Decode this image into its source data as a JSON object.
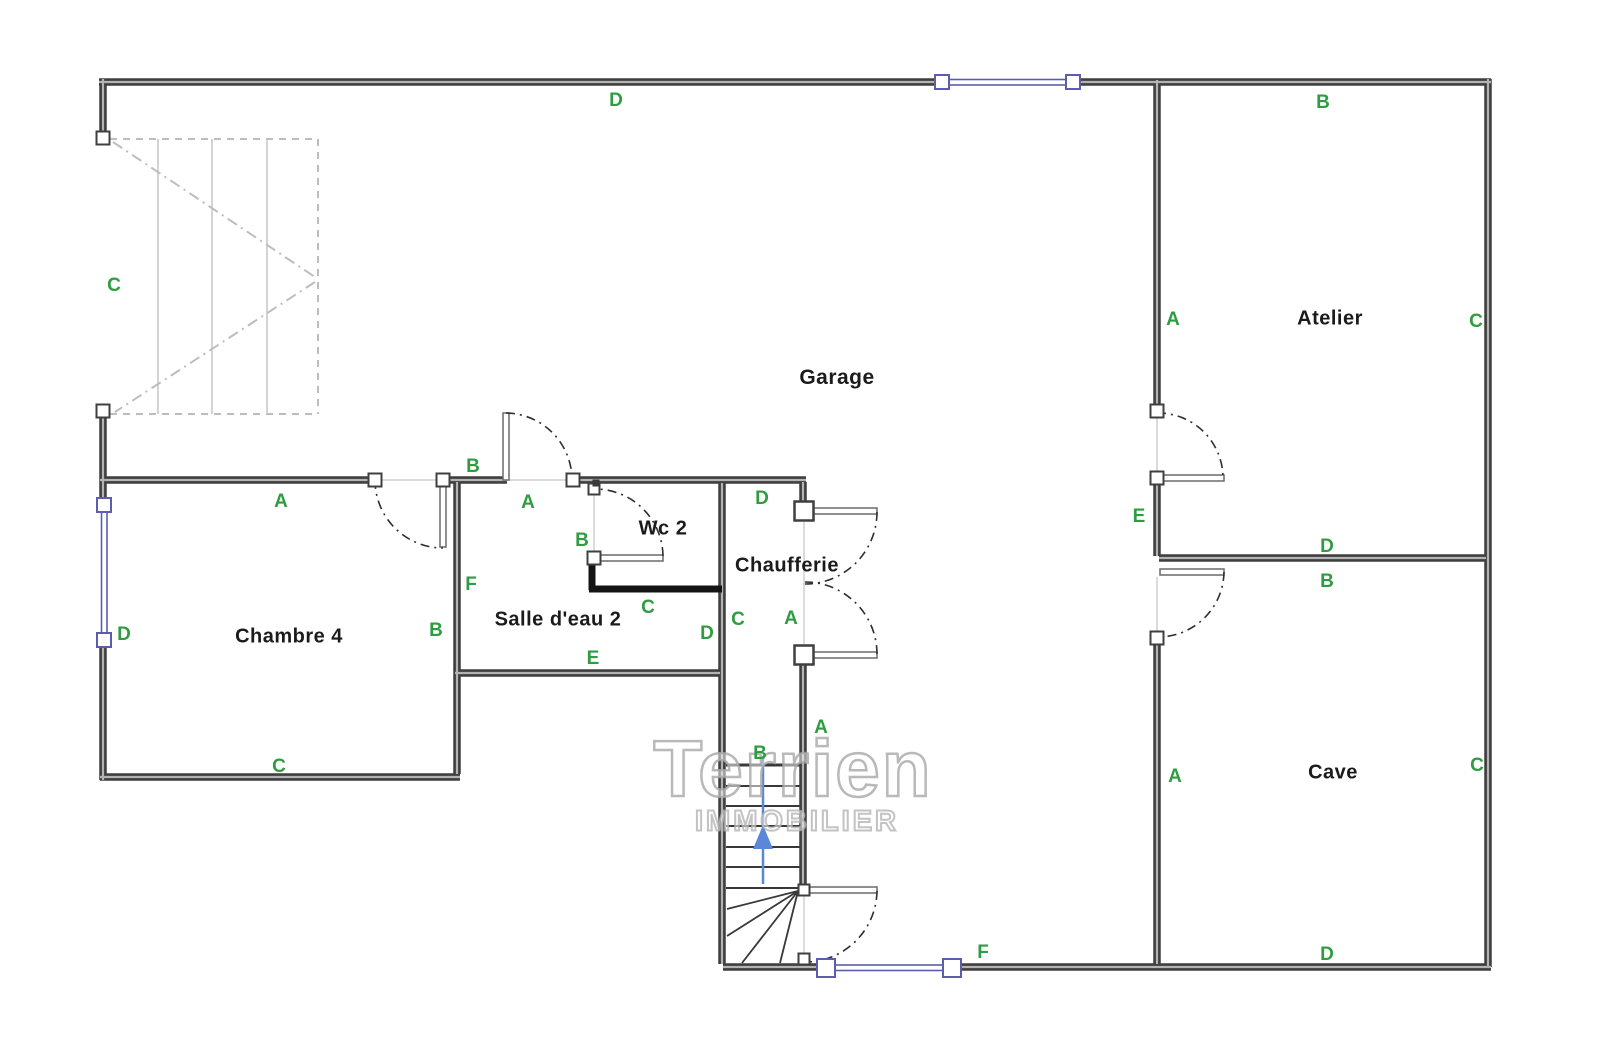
{
  "canvas": {
    "width": 1600,
    "height": 1054,
    "background": "#ffffff"
  },
  "palette": {
    "wall": "#3f3f3f",
    "wall_core": "#b3b3b3",
    "thick_wall": "#141414",
    "leaf_border": "#6a6a6a",
    "window_blue": "#5d5dad",
    "green": "#2f9c42",
    "room_text": "#1b1b1b",
    "thin_line": "#cfcfcf",
    "stair_light": "#bdbdbd",
    "stair_tread_light": "#c6c6c6",
    "stair_dark": "#383838",
    "arc": "#2e2e2e",
    "arrow_blue": "#5988d8"
  },
  "watermark": {
    "line1": "Terrien",
    "line2": "IMMOBILIER",
    "x1": 793,
    "y1": 769,
    "size1": 80,
    "x2": 797,
    "y2": 822,
    "size2": 29
  },
  "room_labels": [
    {
      "id": "garage",
      "text": "Garage",
      "x": 837,
      "y": 378,
      "size": 21
    },
    {
      "id": "atelier",
      "text": "Atelier",
      "x": 1330,
      "y": 319,
      "size": 20
    },
    {
      "id": "cave",
      "text": "Cave",
      "x": 1333,
      "y": 773,
      "size": 20
    },
    {
      "id": "chambre4",
      "text": "Chambre 4",
      "x": 289,
      "y": 637,
      "size": 20
    },
    {
      "id": "salledeau2",
      "text": "Salle d'eau 2",
      "x": 558,
      "y": 620,
      "size": 20
    },
    {
      "id": "wc2",
      "text": "Wc 2",
      "x": 663,
      "y": 529,
      "size": 20
    },
    {
      "id": "chaufferie",
      "text": "Chaufferie",
      "x": 787,
      "y": 566,
      "size": 20
    }
  ],
  "green_markers": [
    {
      "text": "D",
      "x": 616,
      "y": 101
    },
    {
      "text": "B",
      "x": 1323,
      "y": 103
    },
    {
      "text": "C",
      "x": 114,
      "y": 286
    },
    {
      "text": "A",
      "x": 1173,
      "y": 320
    },
    {
      "text": "C",
      "x": 1476,
      "y": 322
    },
    {
      "text": "B",
      "x": 473,
      "y": 467
    },
    {
      "text": "A",
      "x": 281,
      "y": 502
    },
    {
      "text": "A",
      "x": 528,
      "y": 503
    },
    {
      "text": "D",
      "x": 762,
      "y": 499
    },
    {
      "text": "B",
      "x": 582,
      "y": 541
    },
    {
      "text": "E",
      "x": 1139,
      "y": 517
    },
    {
      "text": "D",
      "x": 1327,
      "y": 547
    },
    {
      "text": "B",
      "x": 1327,
      "y": 582
    },
    {
      "text": "F",
      "x": 471,
      "y": 585
    },
    {
      "text": "C",
      "x": 648,
      "y": 608
    },
    {
      "text": "C",
      "x": 738,
      "y": 620
    },
    {
      "text": "A",
      "x": 791,
      "y": 619
    },
    {
      "text": "D",
      "x": 707,
      "y": 634
    },
    {
      "text": "B",
      "x": 436,
      "y": 631
    },
    {
      "text": "D",
      "x": 124,
      "y": 635
    },
    {
      "text": "E",
      "x": 593,
      "y": 659
    },
    {
      "text": "C",
      "x": 279,
      "y": 767
    },
    {
      "text": "A",
      "x": 1175,
      "y": 777
    },
    {
      "text": "C",
      "x": 1477,
      "y": 766
    },
    {
      "text": "B",
      "x": 760,
      "y": 754
    },
    {
      "text": "A",
      "x": 821,
      "y": 728
    },
    {
      "text": "D",
      "x": 1327,
      "y": 955
    },
    {
      "text": "F",
      "x": 983,
      "y": 953
    }
  ],
  "geometry": {
    "walls": [
      [
        99,
        82,
        937,
        82
      ],
      [
        1078,
        82,
        1491,
        82
      ],
      [
        1488,
        79,
        1488,
        967
      ],
      [
        103,
        79,
        103,
        133
      ],
      [
        103,
        415,
        103,
        500
      ],
      [
        103,
        645,
        103,
        780
      ],
      [
        100,
        777,
        460,
        777
      ],
      [
        457,
        482,
        457,
        774
      ],
      [
        100,
        480,
        376,
        480
      ],
      [
        442,
        480,
        507,
        480
      ],
      [
        572,
        480,
        806,
        480
      ],
      [
        722,
        483,
        722,
        964
      ],
      [
        455,
        673,
        720,
        673
      ],
      [
        803,
        482,
        803,
        504
      ],
      [
        803,
        662,
        803,
        886
      ],
      [
        723,
        967,
        820,
        967
      ],
      [
        958,
        967,
        1491,
        967
      ],
      [
        1157,
        80,
        1157,
        407
      ],
      [
        1157,
        481,
        1157,
        556
      ],
      [
        1159,
        558,
        1486,
        558
      ],
      [
        1157,
        641,
        1157,
        964
      ]
    ],
    "thick_walls": [
      [
        592,
        557,
        592,
        590
      ],
      [
        589,
        589,
        722,
        589
      ]
    ],
    "thin_lines": [
      [
        378,
        480,
        440,
        480
      ],
      [
        509,
        480,
        570,
        480
      ],
      [
        594,
        492,
        594,
        552
      ],
      [
        804,
        522,
        804,
        644
      ],
      [
        804,
        896,
        804,
        953
      ],
      [
        1157,
        416,
        1157,
        472
      ],
      [
        1157,
        577,
        1157,
        634
      ]
    ],
    "door_leaves": [
      [
        440,
        481,
        6,
        66
      ],
      [
        503,
        413,
        6,
        67
      ],
      [
        595,
        555,
        68,
        6
      ],
      [
        813,
        508,
        64,
        6
      ],
      [
        813,
        652,
        64,
        6
      ],
      [
        805,
        887,
        72,
        6
      ],
      [
        1160,
        475,
        64,
        6
      ],
      [
        1160,
        569,
        64,
        6
      ]
    ],
    "door_arcs": [
      {
        "sx": 375,
        "sy": 480,
        "r": 68,
        "sweep": 0,
        "ex": 443,
        "ey": 548
      },
      {
        "sx": 506,
        "sy": 413,
        "r": 67,
        "sweep": 1,
        "ex": 572,
        "ey": 480
      },
      {
        "sx": 663,
        "sy": 556,
        "r": 68,
        "sweep": 0,
        "ex": 595,
        "ey": 489
      },
      {
        "sx": 877,
        "sy": 512,
        "r": 72,
        "sweep": 1,
        "ex": 805,
        "ey": 584
      },
      {
        "sx": 877,
        "sy": 654,
        "r": 72,
        "sweep": 0,
        "ex": 805,
        "ey": 582
      },
      {
        "sx": 877,
        "sy": 891,
        "r": 72,
        "sweep": 1,
        "ex": 805,
        "ey": 962
      },
      {
        "sx": 1157,
        "sy": 413,
        "r": 65,
        "sweep": 1,
        "ex": 1223,
        "ey": 478
      },
      {
        "sx": 1224,
        "sy": 572,
        "r": 66,
        "sweep": 1,
        "ex": 1158,
        "ey": 637
      }
    ],
    "windows": [
      [
        949,
        79.5,
        117,
        5.5
      ],
      [
        101.5,
        512,
        5.5,
        121
      ],
      [
        835,
        965,
        110,
        5.5
      ]
    ],
    "window_nodes": [
      [
        942,
        82,
        14
      ],
      [
        1073,
        82,
        14
      ],
      [
        104,
        505,
        14
      ],
      [
        104,
        640,
        14
      ],
      [
        826,
        968,
        18
      ],
      [
        952,
        968,
        18
      ]
    ],
    "nodes": [
      [
        103,
        138,
        13
      ],
      [
        103,
        411,
        13
      ],
      [
        375,
        480,
        13
      ],
      [
        443,
        480,
        13
      ],
      [
        573,
        480,
        13
      ],
      [
        594,
        558,
        13
      ],
      [
        1157,
        411,
        13
      ],
      [
        1157,
        478,
        13
      ],
      [
        1157,
        638,
        13
      ],
      [
        594,
        489,
        11
      ],
      [
        804,
        890,
        11
      ],
      [
        804,
        959,
        11
      ]
    ],
    "dark_nodes": [
      [
        596,
        483,
        7
      ]
    ],
    "pillars": [
      [
        804,
        511,
        19
      ],
      [
        804,
        655,
        19
      ]
    ],
    "stair_top": {
      "dashed_border": [
        [
          110,
          139,
          318,
          139
        ],
        [
          318,
          139,
          318,
          414
        ],
        [
          110,
          414,
          318,
          414
        ]
      ],
      "treads": [
        [
          158,
          139,
          158,
          414
        ],
        [
          212,
          139,
          212,
          414
        ],
        [
          267,
          139,
          267,
          414
        ]
      ],
      "chevrons": [
        [
          113,
          142,
          315,
          277
        ],
        [
          315,
          282,
          115,
          412
        ]
      ]
    },
    "stair_bottom": {
      "treads": [
        [
          726,
          765,
          801,
          765,
          3
        ],
        [
          726,
          786,
          801,
          786,
          2
        ],
        [
          726,
          806,
          801,
          806,
          2
        ],
        [
          726,
          826,
          801,
          826,
          2
        ],
        [
          726,
          847,
          801,
          847,
          2
        ],
        [
          726,
          867,
          801,
          867,
          2
        ],
        [
          726,
          888,
          801,
          888,
          2
        ]
      ],
      "diagonals": [
        [
          798,
          891,
          727,
          909
        ],
        [
          798,
          891,
          727,
          936
        ],
        [
          798,
          891,
          742,
          963
        ],
        [
          798,
          891,
          780,
          963
        ]
      ]
    },
    "arrow": {
      "line": [
        763,
        884,
        763,
        757
      ],
      "head": "763,825 753,849 773,849"
    }
  }
}
